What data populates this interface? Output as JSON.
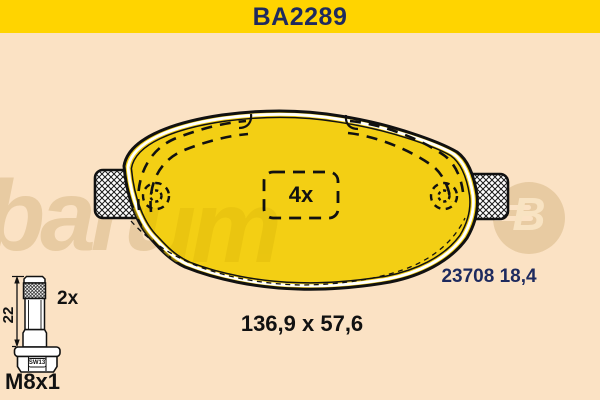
{
  "header": {
    "title": "BA2289"
  },
  "labels": {
    "pad_quantity": "4x",
    "pad_ref": "23708 18,4",
    "pad_dimensions": "136,9 x 57,6",
    "bolt_quantity": "2x",
    "bolt_length": "22",
    "bolt_wrench": "SW13",
    "bolt_thread": "M8x1"
  },
  "watermark": {
    "wordmark": "barum",
    "badge_letter": "B"
  },
  "colors": {
    "header_bg": "#FFD400",
    "canvas_bg": "#FBE2C4",
    "pad_yellow": "#F3CF14",
    "navy": "#1E2A5E",
    "ink": "#111111",
    "watermark_tan": "#E8CBA2"
  }
}
